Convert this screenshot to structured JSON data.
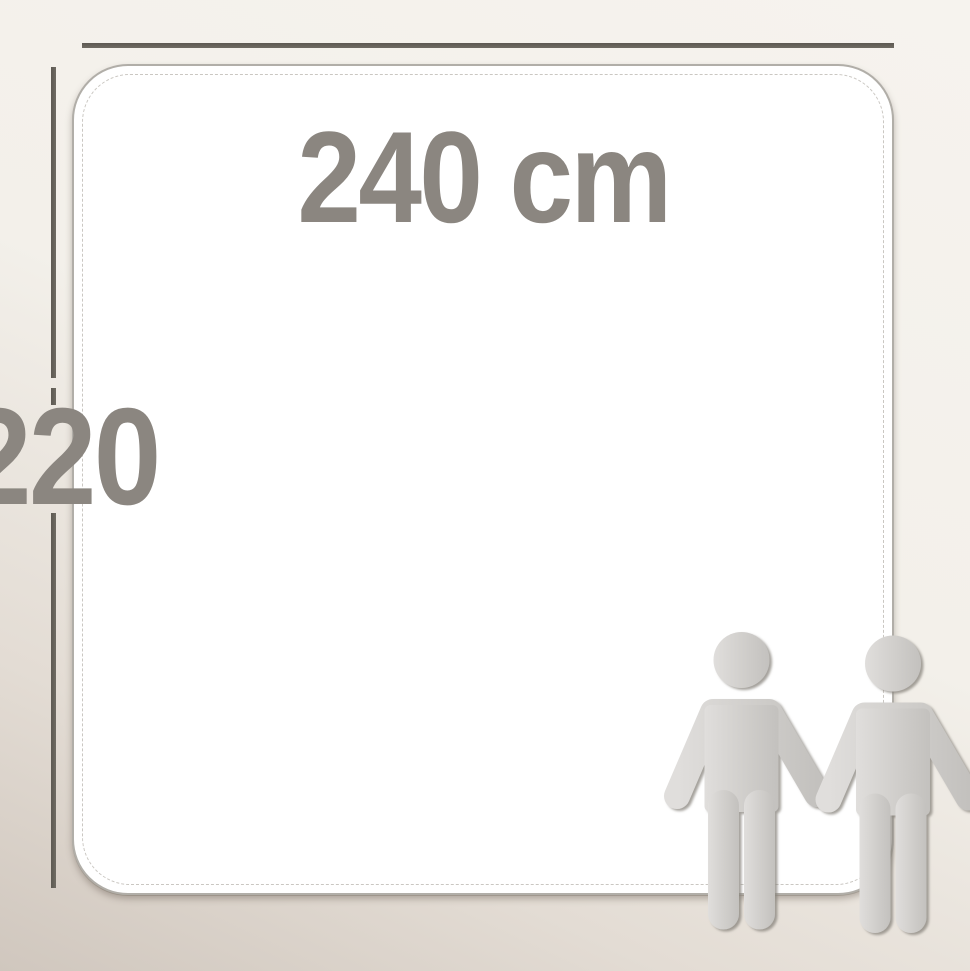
{
  "labels": {
    "width": "240 cm",
    "height": "220"
  },
  "figures": {
    "count": 2,
    "icon": "person-icon"
  },
  "colors": {
    "background_top": "#f6f3ee",
    "background_bottom": "#d0c7be",
    "dimension_line": "#6f6b63",
    "label_text": "#8b8680",
    "panel_fill": "#ffffff",
    "panel_border": "#b1aea8",
    "seam_line": "#cac7c2",
    "figure_fill": "#d0cecb",
    "figure_shadow": "#86827c"
  }
}
